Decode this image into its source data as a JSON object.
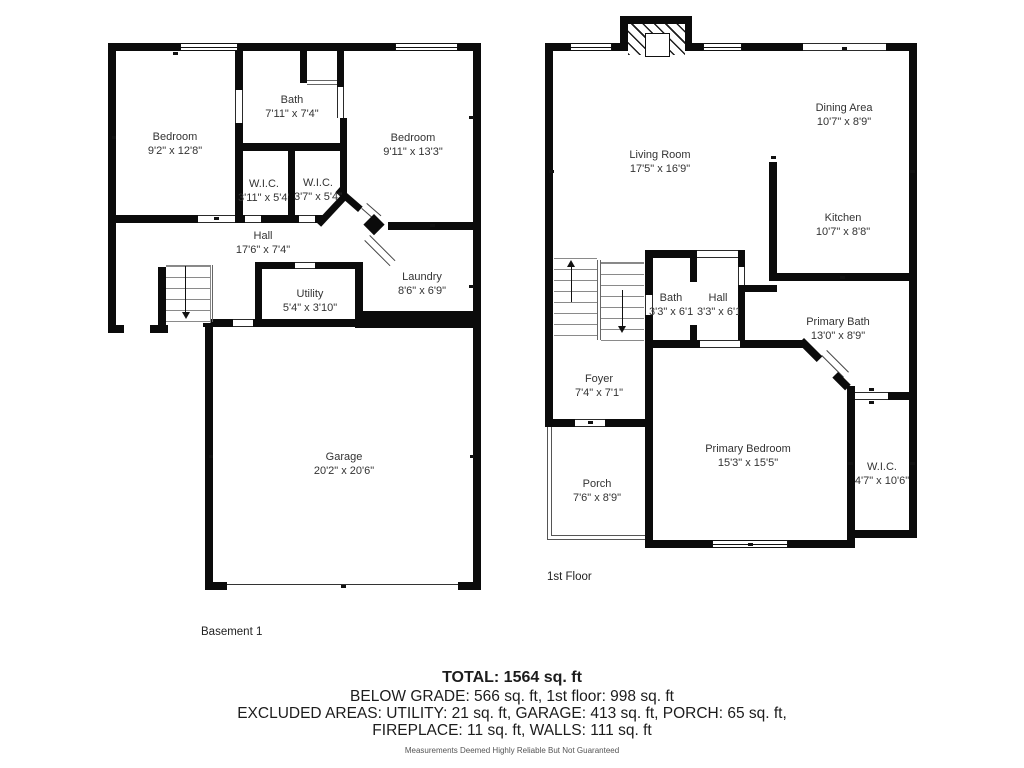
{
  "basement": {
    "title": "Basement 1",
    "rooms": {
      "bedroom_left": {
        "name": "Bedroom",
        "dims": "9'2\" x 12'8\""
      },
      "bath": {
        "name": "Bath",
        "dims": "7'11\" x 7'4\""
      },
      "bedroom_right": {
        "name": "Bedroom",
        "dims": "9'11\" x 13'3\""
      },
      "wic_left": {
        "name": "W.I.C.",
        "dims": "3'11\" x 5'4\""
      },
      "wic_right": {
        "name": "W.I.C.",
        "dims": "3'7\" x 5'4\""
      },
      "hall": {
        "name": "Hall",
        "dims": "17'6\" x 7'4\""
      },
      "utility": {
        "name": "Utility",
        "dims": "5'4\" x 3'10\""
      },
      "laundry": {
        "name": "Laundry",
        "dims": "8'6\" x 6'9\""
      },
      "garage": {
        "name": "Garage",
        "dims": "20'2\" x 20'6\""
      }
    }
  },
  "first_floor": {
    "title": "1st Floor",
    "rooms": {
      "living_room": {
        "name": "Living Room",
        "dims": "17'5\" x 16'9\""
      },
      "dining_area": {
        "name": "Dining Area",
        "dims": "10'7\" x 8'9\""
      },
      "kitchen": {
        "name": "Kitchen",
        "dims": "10'7\" x 8'8\""
      },
      "bath": {
        "name": "Bath",
        "dims": "3'3\" x 6'11\""
      },
      "hall": {
        "name": "Hall",
        "dims": "3'3\" x 6'11\""
      },
      "primary_bath": {
        "name": "Primary Bath",
        "dims": "13'0\" x 8'9\""
      },
      "foyer": {
        "name": "Foyer",
        "dims": "7'4\" x 7'1\""
      },
      "porch": {
        "name": "Porch",
        "dims": "7'6\" x 8'9\""
      },
      "primary_bedroom": {
        "name": "Primary Bedroom",
        "dims": "15'3\" x 15'5\""
      },
      "wic": {
        "name": "W.I.C.",
        "dims": "4'7\" x 10'6\""
      }
    }
  },
  "summary": {
    "total": "TOTAL: 1564 sq. ft",
    "grade_line": "BELOW GRADE: 566 sq. ft, 1st floor: 998 sq. ft",
    "excluded_line1": "EXCLUDED AREAS: UTILITY: 21 sq. ft, GARAGE: 413 sq. ft, PORCH: 65 sq. ft,",
    "excluded_line2": "FIREPLACE: 11 sq. ft, WALLS: 111 sq. ft",
    "disclaimer": "Measurements Deemed Highly Reliable But Not Guaranteed"
  }
}
